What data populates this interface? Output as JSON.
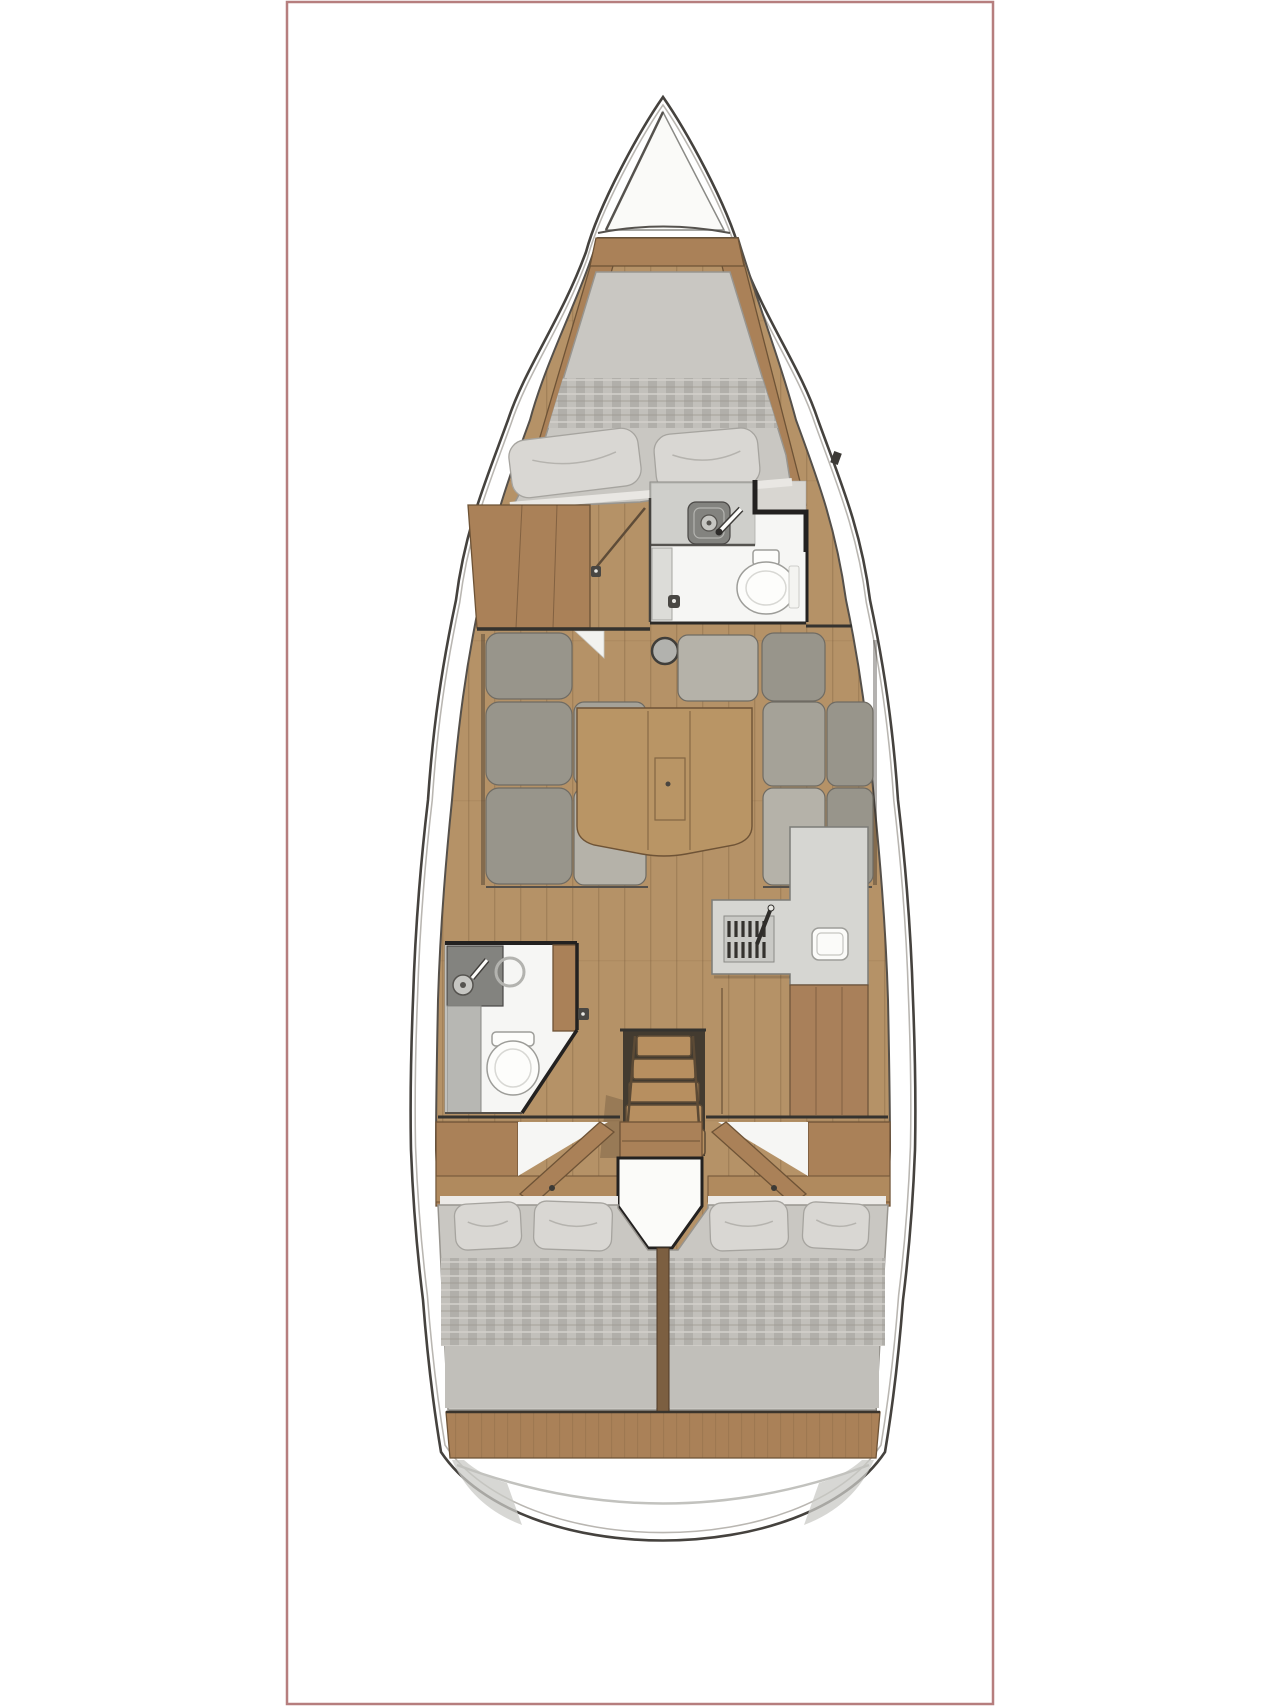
{
  "meta": {
    "type": "boat-floorplan",
    "description": "Top-down interior layout plan of a sailing yacht, three cabins, two heads, saloon, galley and companionway, drawn inside a thin red rectangular frame on a white page",
    "visible_text": []
  },
  "layout": {
    "image_width": 1280,
    "image_height": 1707,
    "frame": {
      "x": 287,
      "y": 2,
      "width": 706,
      "height": 1702
    },
    "boat": {
      "centerline_x": 663,
      "bow_tip_y": 97,
      "stern_bottom_y": 1540
    }
  },
  "palette": {
    "background": "#ffffff",
    "frame_border": "#b67e7e",
    "hull_outline": "#45423e",
    "hull_fill": "#ffffff",
    "hull_inner": "#b9b6b1",
    "interior_outline": "#55504a",
    "wood_floor": "#b59267",
    "wood_floor_line": "#6b4f33",
    "wood_furniture": "#aa8158",
    "wood_furniture_dark": "#6e5336",
    "wood_table": "#b99565",
    "wood_stairs": "#b78f60",
    "wood_post": "#7c5f41",
    "cushion_back": "#98958b",
    "cushion_seat": "#b5b2a9",
    "cushion_seat_shadow": "#a5a298",
    "cushion_edge": "#6f6b63",
    "mattress": "#c9c7c2",
    "mattress_edge": "#98958f",
    "plaid_a": "#b1afaa",
    "plaid_b": "#c2c0bb",
    "pillow": "#d9d7d3",
    "pillow_edge": "#a6a49f",
    "counter_dark": "#83837f",
    "counter_light": "#cfcfcb",
    "galley_counter": "#d6d6d2",
    "fixture_white": "#fdfdfb",
    "fixture_edge": "#9d9d99",
    "wall_dark": "#232120",
    "stove_dark": "#34322e",
    "white_floor": "#f6f6f4",
    "transom_shade": "#c9c9c5"
  },
  "regions": [
    {
      "name": "bow-anchor-locker",
      "features": [
        "locker-triangle"
      ]
    },
    {
      "name": "forward-cabin",
      "features": [
        "v-berth-double-bed",
        "plaid-blanket-band",
        "pillow",
        "pillow",
        "side-shelves",
        "wardrobe"
      ]
    },
    {
      "name": "forward-head",
      "features": [
        "sink",
        "faucet",
        "toilet",
        "door"
      ]
    },
    {
      "name": "saloon",
      "features": [
        "port-settee-3-back-cushions",
        "port-settee-2-seat-cushions",
        "starboard-l-settee",
        "folding-table",
        "mast-post"
      ]
    },
    {
      "name": "galley",
      "features": [
        "l-shaped-counter",
        "stove-grill",
        "faucet",
        "sink",
        "lower-cabinet"
      ]
    },
    {
      "name": "aft-head",
      "features": [
        "sink",
        "faucet",
        "shower-ring",
        "toilet",
        "door"
      ]
    },
    {
      "name": "companionway",
      "features": [
        "step",
        "step",
        "step",
        "step",
        "base-step"
      ]
    },
    {
      "name": "aft-cabin-port",
      "features": [
        "double-bed",
        "pillow",
        "pillow",
        "plaid-blanket-band",
        "cabin-door"
      ]
    },
    {
      "name": "aft-cabin-starboard",
      "features": [
        "double-bed",
        "pillow",
        "pillow",
        "plaid-blanket-band",
        "cabin-door"
      ]
    },
    {
      "name": "engine-box",
      "features": [
        "white-housing"
      ]
    },
    {
      "name": "stern-transom",
      "features": [
        "wood-deck-band",
        "swim-platform"
      ]
    }
  ],
  "counts": {
    "cabins": 3,
    "heads": 2,
    "pillows": 6,
    "companionway_steps": 5
  }
}
